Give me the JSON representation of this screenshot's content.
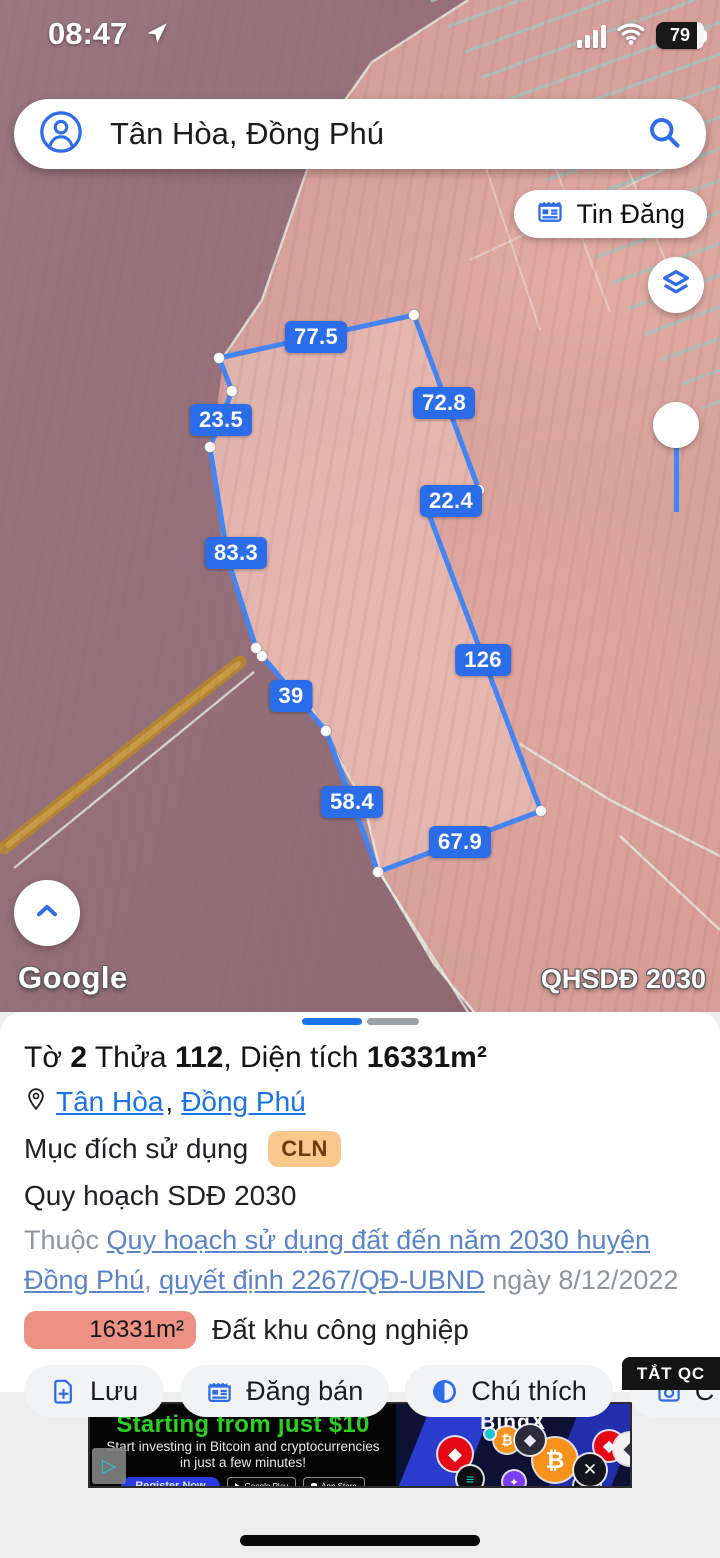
{
  "status_bar": {
    "time": "08:47",
    "battery": "79"
  },
  "search": {
    "query": "Tân Hòa, Đồng Phú"
  },
  "map": {
    "tin_dang_label": "Tin Đăng",
    "google_logo": "Google",
    "overlay_tag": "QHSDĐ 2030",
    "parcel": {
      "stroke": "#4285f4",
      "label_bg": "#2b6de8",
      "vertices": [
        [
          414,
          315,
          1
        ],
        [
          479,
          490,
          1
        ],
        [
          427,
          509,
          1
        ],
        [
          541,
          811,
          1
        ],
        [
          378,
          872,
          1
        ],
        [
          326,
          731,
          1
        ],
        [
          262,
          656,
          1
        ],
        [
          256,
          648,
          1
        ],
        [
          228,
          560,
          0
        ],
        [
          210,
          447,
          1
        ],
        [
          232,
          391,
          1
        ],
        [
          219,
          358,
          1
        ]
      ],
      "edge_labels": [
        {
          "text": "77.5",
          "x": 316,
          "y": 337
        },
        {
          "text": "72.8",
          "x": 444,
          "y": 403
        },
        {
          "text": "23.5",
          "x": 221,
          "y": 420
        },
        {
          "text": "22.4",
          "x": 451,
          "y": 501
        },
        {
          "text": "83.3",
          "x": 236,
          "y": 553
        },
        {
          "text": "126",
          "x": 483,
          "y": 660
        },
        {
          "text": "39",
          "x": 291,
          "y": 696
        },
        {
          "text": "58.4",
          "x": 352,
          "y": 802
        },
        {
          "text": "67.9",
          "x": 460,
          "y": 842
        }
      ]
    }
  },
  "sheet": {
    "title_parts": [
      {
        "t": "Tờ ",
        "b": false
      },
      {
        "t": "2",
        "b": true
      },
      {
        "t": " Thửa ",
        "b": false
      },
      {
        "t": "112",
        "b": true
      },
      {
        "t": ", Diện tích ",
        "b": false
      },
      {
        "t": "16331m²",
        "b": true
      }
    ],
    "location": {
      "link1": "Tân Hòa",
      "sep": ",",
      "link2": "Đồng Phú"
    },
    "purpose_label": "Mục đích sử dụng",
    "purpose_code": "CLN",
    "plan_label": "Quy hoạch SDĐ 2030",
    "belongs": {
      "prefix": "Thuộc ",
      "link1": "Quy hoạch sử dụng đất đến năm 2030 huyện Đồng Phú",
      "mid": ", ",
      "link2": "quyết định 2267/QĐ-UBND",
      "suffix": " ngày 8/12/2022"
    },
    "area_chip": {
      "value": "16331m²",
      "color": "#ec9184"
    },
    "zoning_text": "Đất khu công nghiệp",
    "actions": [
      {
        "label": "Lưu",
        "icon": "file-plus"
      },
      {
        "label": "Đăng bán",
        "icon": "listing"
      },
      {
        "label": "Chú thích",
        "icon": "contrast"
      },
      {
        "label": "C",
        "icon": "camera-plus"
      }
    ],
    "dismiss_ad": "TẮT QC"
  },
  "ad": {
    "headline": "Starting from just $10",
    "sub1": "Start investing in Bitcoin and cryptocurrencies",
    "sub2": "in just a few minutes!",
    "cta": "Register Now",
    "store1": "Google Play",
    "store2": "App Store",
    "brand": "BingX",
    "coins": [
      {
        "sym": "₿",
        "bg": "#f7931a",
        "fg": "#ffffff",
        "x": 417,
        "y": 36,
        "d": 26
      },
      {
        "sym": "₿",
        "bg": "#f7931a",
        "fg": "#ffffff",
        "x": 465,
        "y": 56,
        "d": 44
      },
      {
        "sym": "◆",
        "bg": "#e50915",
        "fg": "#ffffff",
        "x": 365,
        "y": 50,
        "d": 34
      },
      {
        "sym": "◆",
        "bg": "#e50915",
        "fg": "#ffffff",
        "x": 519,
        "y": 42,
        "d": 30
      },
      {
        "sym": "◆",
        "bg": "#2b2b3d",
        "fg": "#e8e8f5",
        "x": 440,
        "y": 36,
        "d": 30
      },
      {
        "sym": "◆",
        "bg": "#f2f2f2",
        "fg": "#35353f",
        "x": 540,
        "y": 45,
        "d": 32
      },
      {
        "sym": "≡",
        "bg": "#0d0d14",
        "fg": "#1fd4c0",
        "x": 380,
        "y": 75,
        "d": 26
      },
      {
        "sym": "≡",
        "bg": "#0d0d14",
        "fg": "#1fd4c0",
        "x": 497,
        "y": 82,
        "d": 26
      },
      {
        "sym": "Ð",
        "bg": "#c9a72b",
        "fg": "#6e5512",
        "x": 557,
        "y": 75,
        "d": 30
      },
      {
        "sym": "✕",
        "bg": "#14141c",
        "fg": "#ffffff",
        "x": 500,
        "y": 66,
        "d": 32
      },
      {
        "sym": "✦",
        "bg": "#7a3ff2",
        "fg": "#ffffff",
        "x": 424,
        "y": 78,
        "d": 22
      },
      {
        "sym": "",
        "bg": "#19c4d6",
        "fg": "#ffffff",
        "x": 400,
        "y": 30,
        "d": 10
      },
      {
        "sym": "",
        "bg": "#19c4d6",
        "fg": "#ffffff",
        "x": 560,
        "y": 18,
        "d": 10
      }
    ]
  }
}
